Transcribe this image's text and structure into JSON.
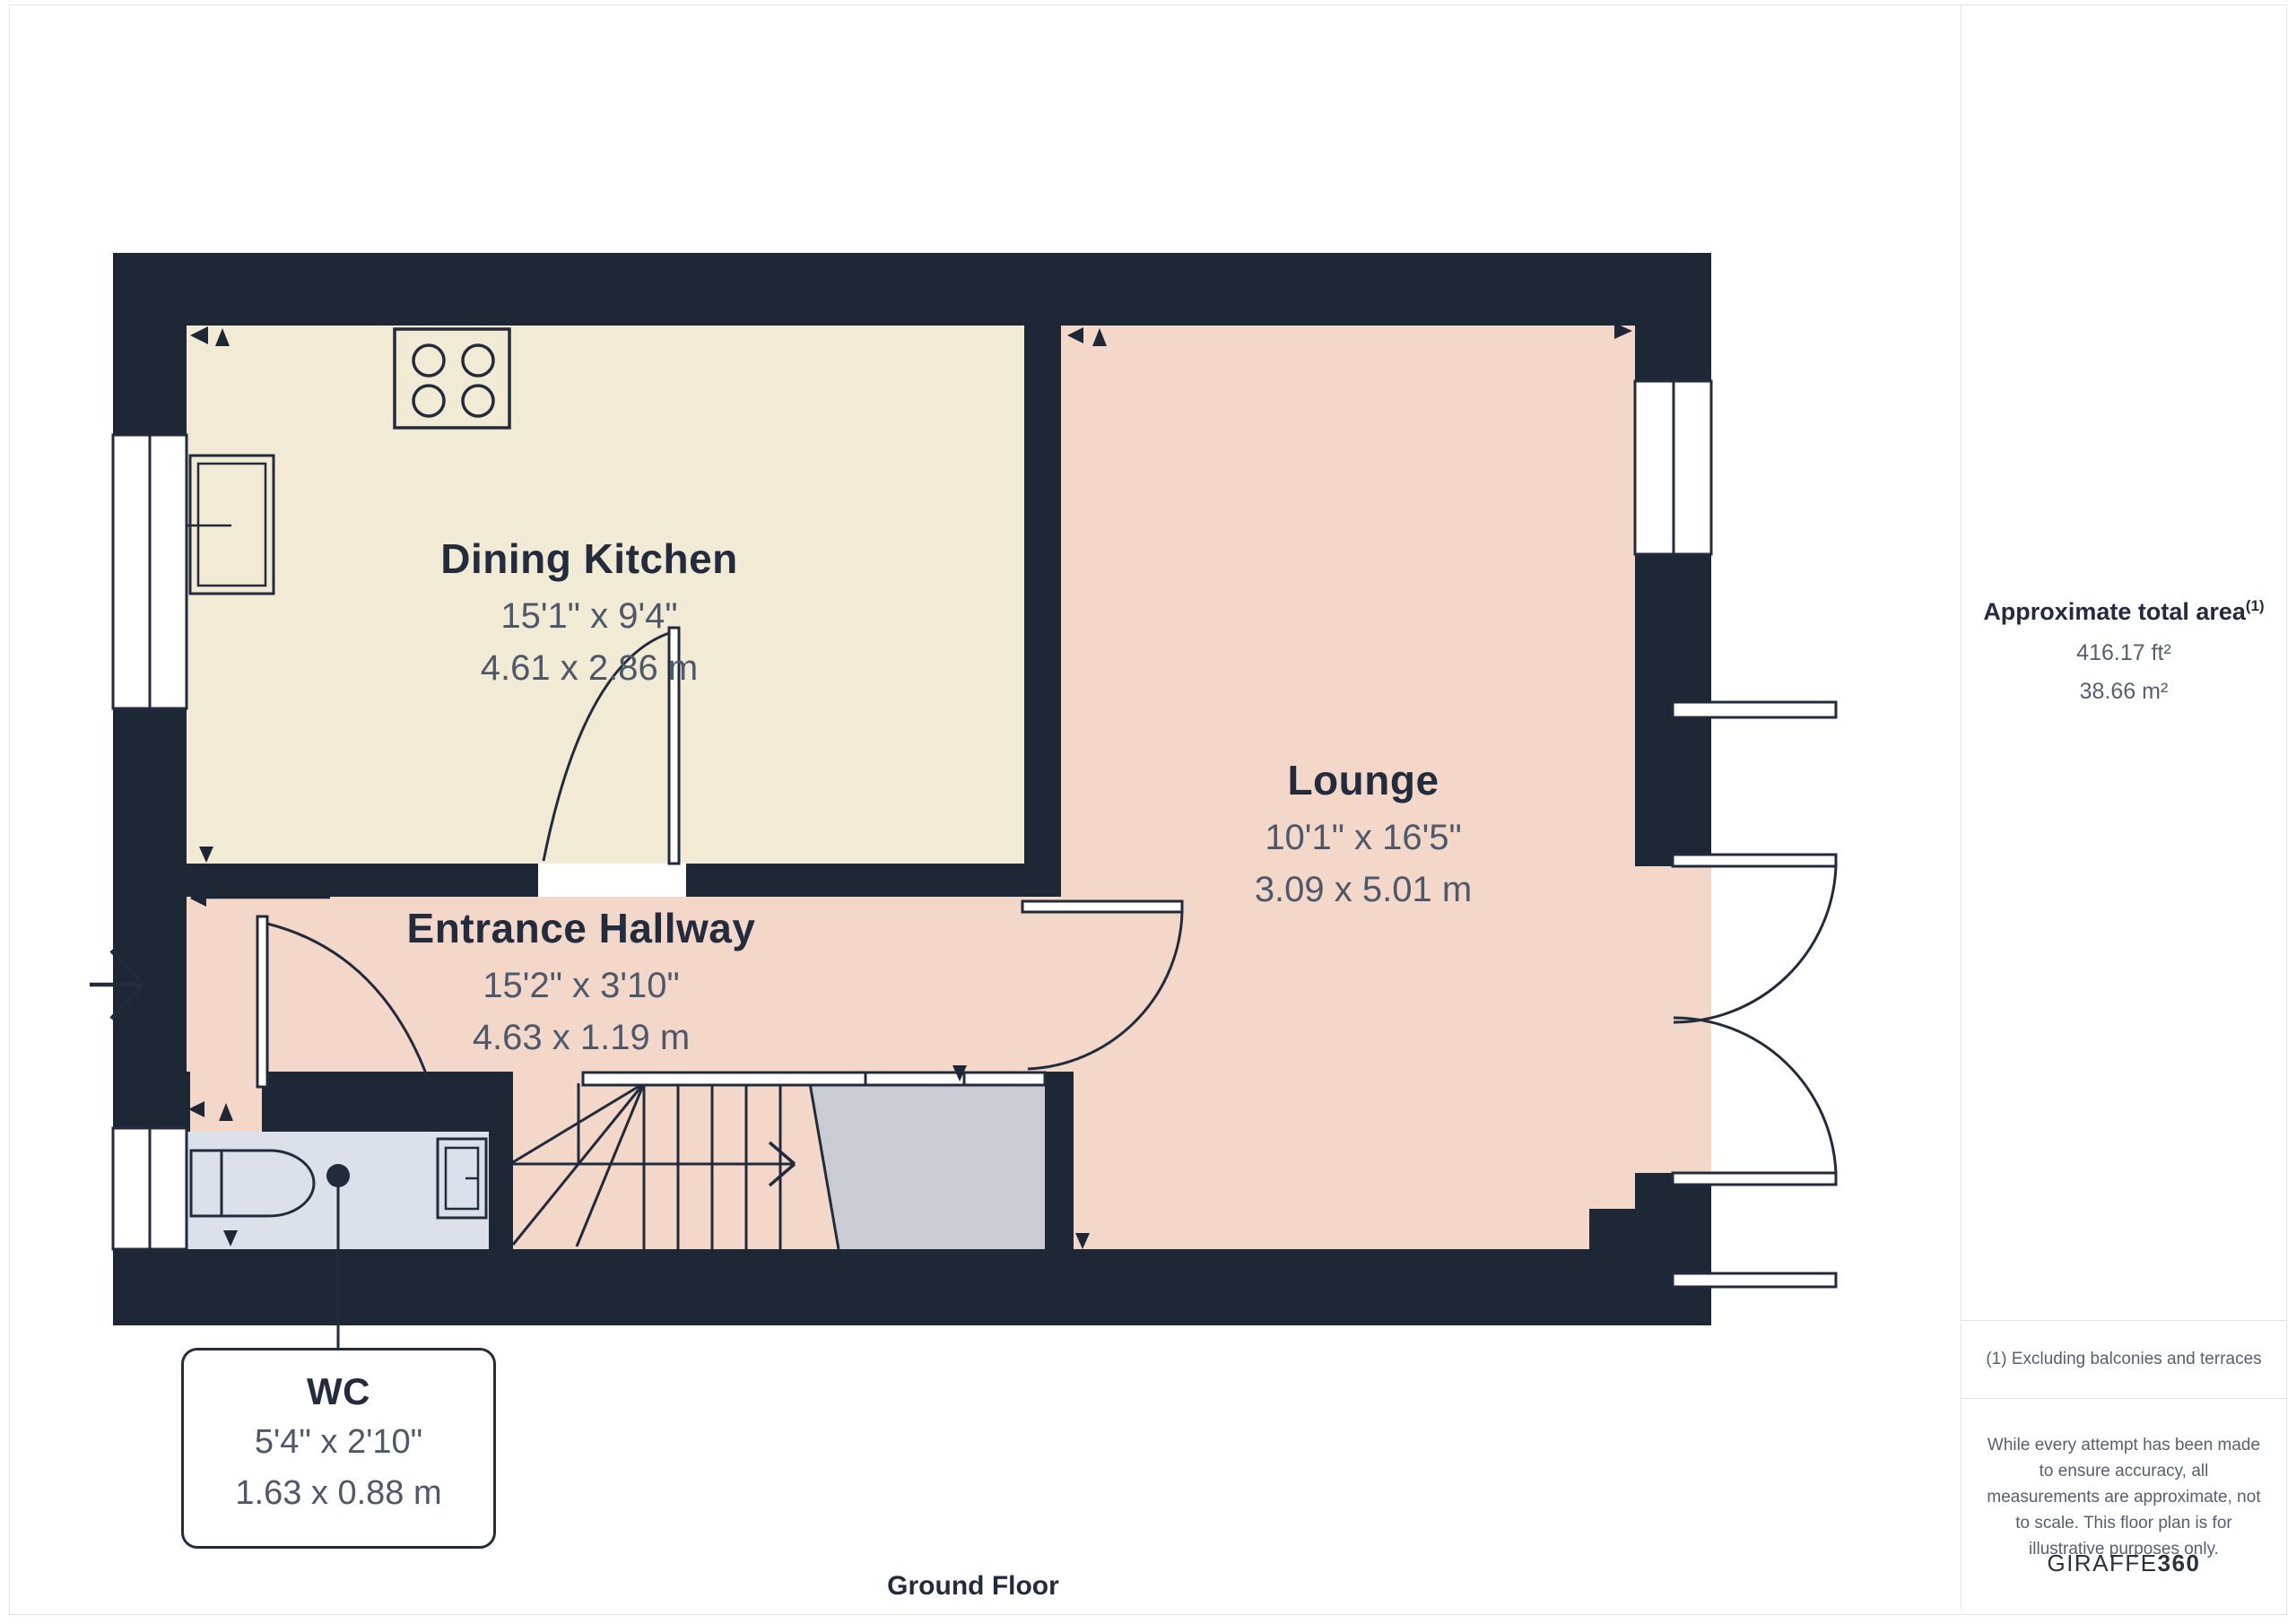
{
  "plan": {
    "floor_label": "Ground Floor",
    "rooms": [
      {
        "name": "Dining Kitchen",
        "imperial": "15'1\" x 9'4\"",
        "metric": "4.61 x 2.86 m"
      },
      {
        "name": "Lounge",
        "imperial": "10'1\" x 16'5\"",
        "metric": "3.09 x 5.01 m"
      },
      {
        "name": "Entrance Hallway",
        "imperial": "15'2\" x 3'10\"",
        "metric": "4.63 x 1.19 m"
      },
      {
        "name": "WC",
        "imperial": "5'4\" x 2'10\"",
        "metric": "1.63 x 0.88 m"
      }
    ]
  },
  "sidebar": {
    "area_title": "Approximate total area",
    "area_superscript": "(1)",
    "area_ft": "416.17 ft²",
    "area_m": "38.66 m²",
    "footnote": "(1) Excluding balconies and terraces",
    "disclaimer": "While every attempt has been made to ensure accuracy, all measurements are approximate, not to scale. This floor plan is for illustrative purposes only.",
    "brand_name": "GIRAFFE",
    "brand_suffix": "360"
  },
  "colors": {
    "wall": "#1d2735",
    "kitchen_floor": "#f1ead5",
    "lounge_floor": "#f3d8ca",
    "wc_floor": "#dbe0eb",
    "storage_floor": "#c9ccd2",
    "title_text": "#232c3e",
    "dim_text": "#4d596b",
    "sidebar_text": "#566070"
  }
}
